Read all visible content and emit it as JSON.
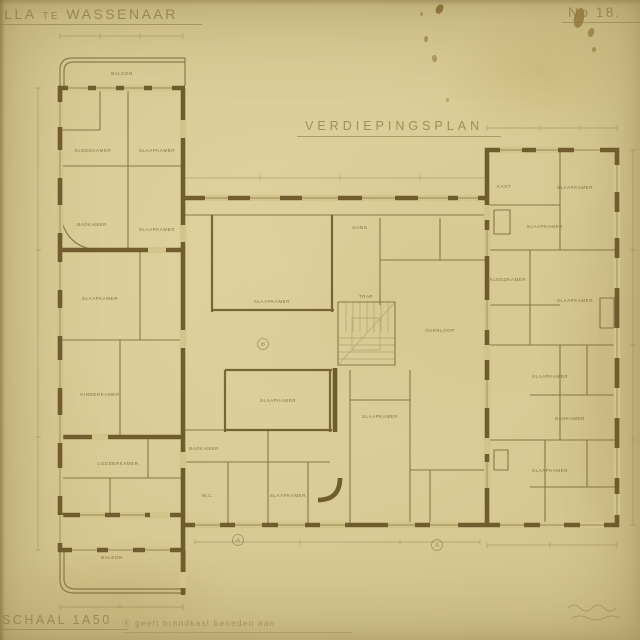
{
  "sheet": {
    "project_title": "VILLA te WASSENAAR",
    "sheet_number": "No 18.",
    "plan_title": "VERDIEPINGSPLAN",
    "scale_label": "SCHAAL 1A50",
    "footnote": "Ⓐ geeft brandkast beneden aan",
    "colors": {
      "paper": "#d3c48c",
      "wall_poche": "#6a5628",
      "thin_line": "#79683a",
      "pencil": "#9c8d5e",
      "ink_text": "#8d7a45"
    }
  },
  "plan": {
    "rooms": [
      {
        "label": "BALKON",
        "x": 122,
        "y": 75
      },
      {
        "label": "KLEEDKAMER",
        "x": 93,
        "y": 152
      },
      {
        "label": "SLAAPKAMER",
        "x": 157,
        "y": 152
      },
      {
        "label": "BADKAMER",
        "x": 92,
        "y": 226
      },
      {
        "label": "SLAAPKAMER",
        "x": 157,
        "y": 231
      },
      {
        "label": "SLAAPKAMER",
        "x": 100,
        "y": 300
      },
      {
        "label": "KINDERKAMER",
        "x": 100,
        "y": 396
      },
      {
        "label": "LOGEERKAMER",
        "x": 118,
        "y": 465
      },
      {
        "label": "BALKON",
        "x": 112,
        "y": 559
      },
      {
        "label": "GANG",
        "x": 360,
        "y": 229
      },
      {
        "label": "SLAAPKAMER",
        "x": 272,
        "y": 303
      },
      {
        "label": "TRAP",
        "x": 366,
        "y": 298
      },
      {
        "label": "OVERLOOP",
        "x": 440,
        "y": 332
      },
      {
        "label": "SLAAPKAMER",
        "x": 278,
        "y": 402
      },
      {
        "label": "BADKAMER",
        "x": 204,
        "y": 450
      },
      {
        "label": "W.C.",
        "x": 208,
        "y": 497
      },
      {
        "label": "SLAAPKAMER",
        "x": 288,
        "y": 497
      },
      {
        "label": "SLAAPKAMER",
        "x": 380,
        "y": 418
      },
      {
        "label": "KAST",
        "x": 504,
        "y": 188
      },
      {
        "label": "SLAAPKAMER",
        "x": 575,
        "y": 189
      },
      {
        "label": "SLAAPKAMER",
        "x": 545,
        "y": 228
      },
      {
        "label": "KLEEDKAMER",
        "x": 508,
        "y": 281
      },
      {
        "label": "SLAAPKAMER",
        "x": 575,
        "y": 302
      },
      {
        "label": "SLAAPKAMER",
        "x": 550,
        "y": 378
      },
      {
        "label": "BADKAMER",
        "x": 570,
        "y": 420
      },
      {
        "label": "SLAAPKAMER",
        "x": 550,
        "y": 472
      }
    ],
    "markers": [
      {
        "letter": "B",
        "x": 263,
        "y": 344
      },
      {
        "letter": "A",
        "x": 238,
        "y": 540
      },
      {
        "letter": "A",
        "x": 437,
        "y": 545
      }
    ]
  }
}
